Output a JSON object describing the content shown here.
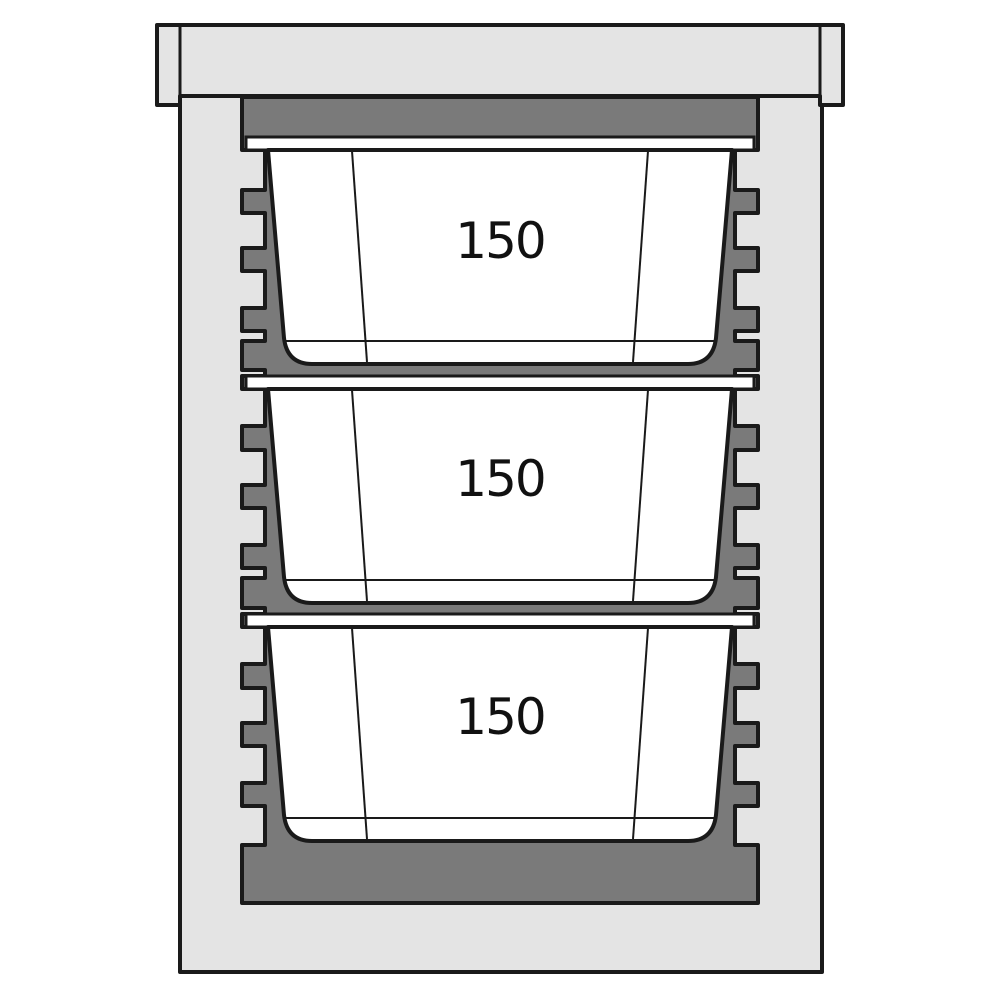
{
  "diagram": {
    "description_label": "insulated-transport-box-cross-section",
    "containers": [
      {
        "label": "150"
      },
      {
        "label": "150"
      },
      {
        "label": "150"
      }
    ],
    "colors": {
      "background": "#ffffff",
      "body_light": "#e4e4e4",
      "liner_dark": "#7a7a7a",
      "container_white": "#ffffff",
      "outline": "#1a1a1a"
    }
  }
}
